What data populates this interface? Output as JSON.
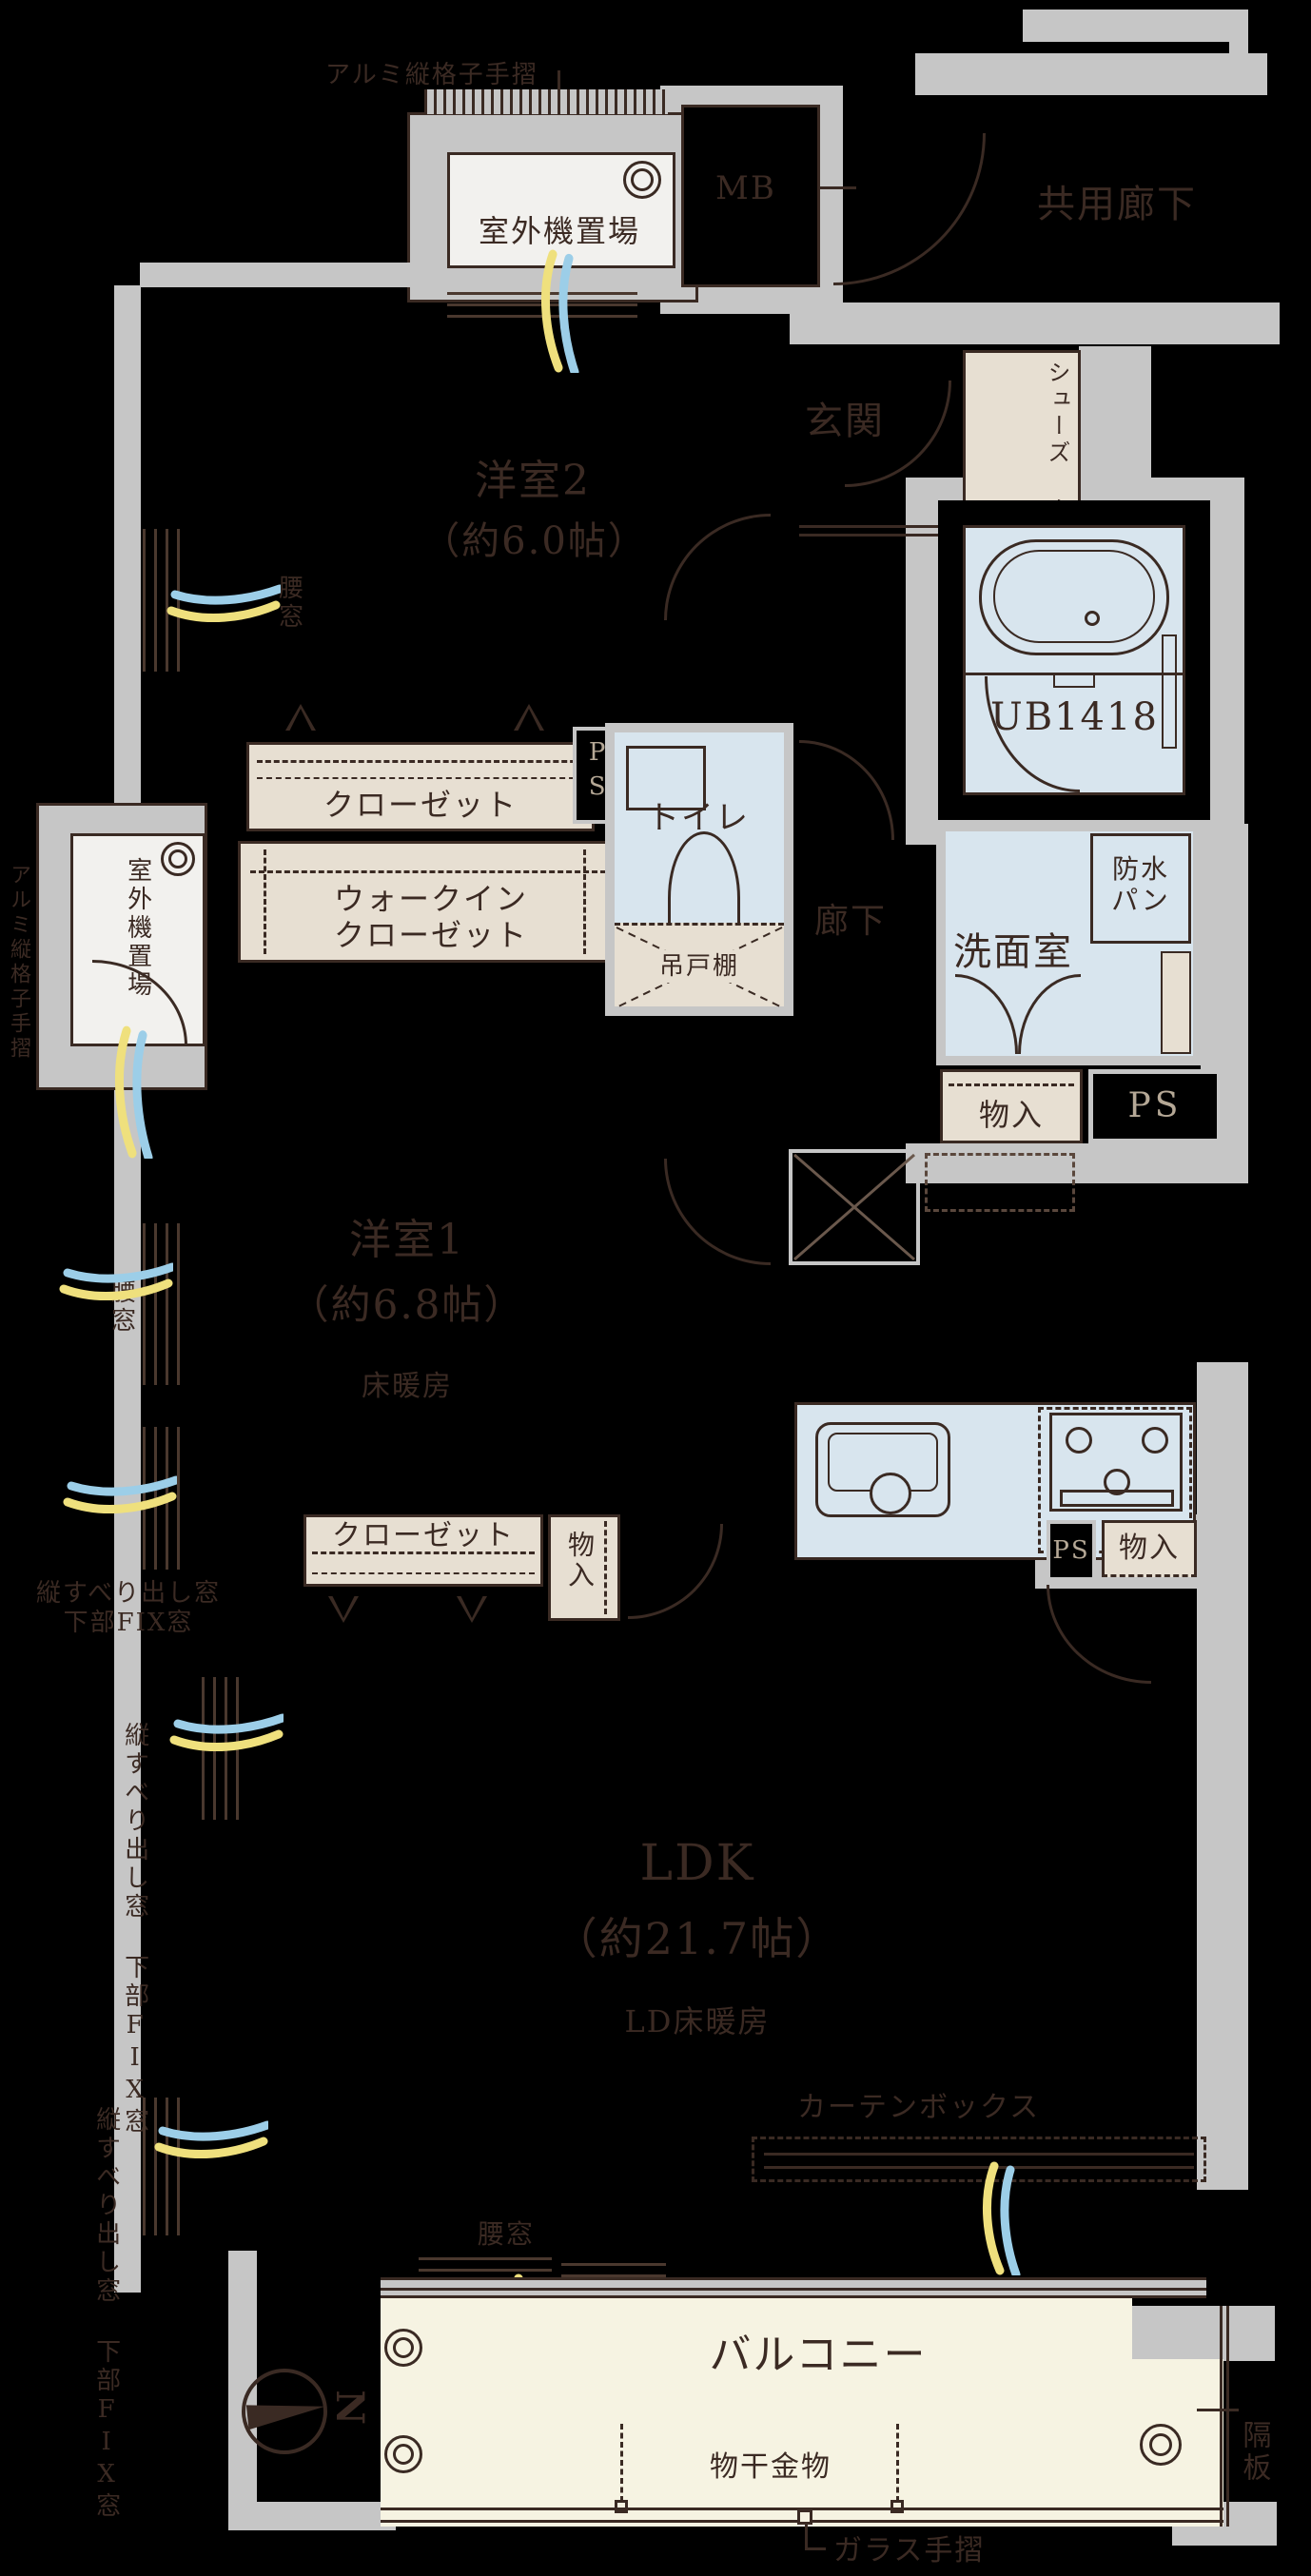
{
  "colors": {
    "background": "#000000",
    "structure_gray": "#c6c6c6",
    "line_brown": "#3a2a23",
    "wet_blue": "#d8e5ee",
    "closet_beige": "#e7dfd2",
    "balcony_cream": "#f6f3e2",
    "air_yellow": "#efe07d",
    "air_blue": "#9ccee8",
    "ps_text": "#b5a896"
  },
  "rooms": {
    "common_corridor": "共用廊下",
    "entrance": "玄関",
    "hallway": "廊下",
    "toilet": "トイレ",
    "washroom": "洗面室",
    "bath": "UB1418",
    "western_room_2": {
      "name": "洋室2",
      "size": "（約6.0帖）"
    },
    "western_room_1": {
      "name": "洋室1",
      "size": "（約6.8帖）",
      "floor_heating": "床暖房"
    },
    "ldk": {
      "name": "LDK",
      "size": "（約21.7帖）",
      "floor_heating": "LD床暖房"
    },
    "balcony": "バルコニー"
  },
  "storage": {
    "meter_box": "MB",
    "pipe_space": "PS",
    "shoes_closet_lines": [
      "シューズ",
      "クローゼット"
    ],
    "closet": "クローゼット",
    "walk_in_closet_lines": [
      "ウォークイン",
      "クローゼット"
    ],
    "storage": "物入",
    "hanging_shelf": "吊戸棚",
    "waterproof_pan_lines": [
      "防水",
      "パン"
    ]
  },
  "fixtures": {
    "outdoor_unit": "室外機置場",
    "aluminum_lattice_rail": "アルミ縦格子手摺",
    "curtain_box": "カーテンボックス",
    "drying_fixture": "物干金物",
    "glass_rail": "ガラス手摺",
    "partition_board": "隔板",
    "north_mark": "N"
  },
  "windows": {
    "waist_window": "腰窓",
    "vertical_sliding_window": "縦すべり出し窓",
    "lower_fix_window": "下部FIX窓"
  }
}
